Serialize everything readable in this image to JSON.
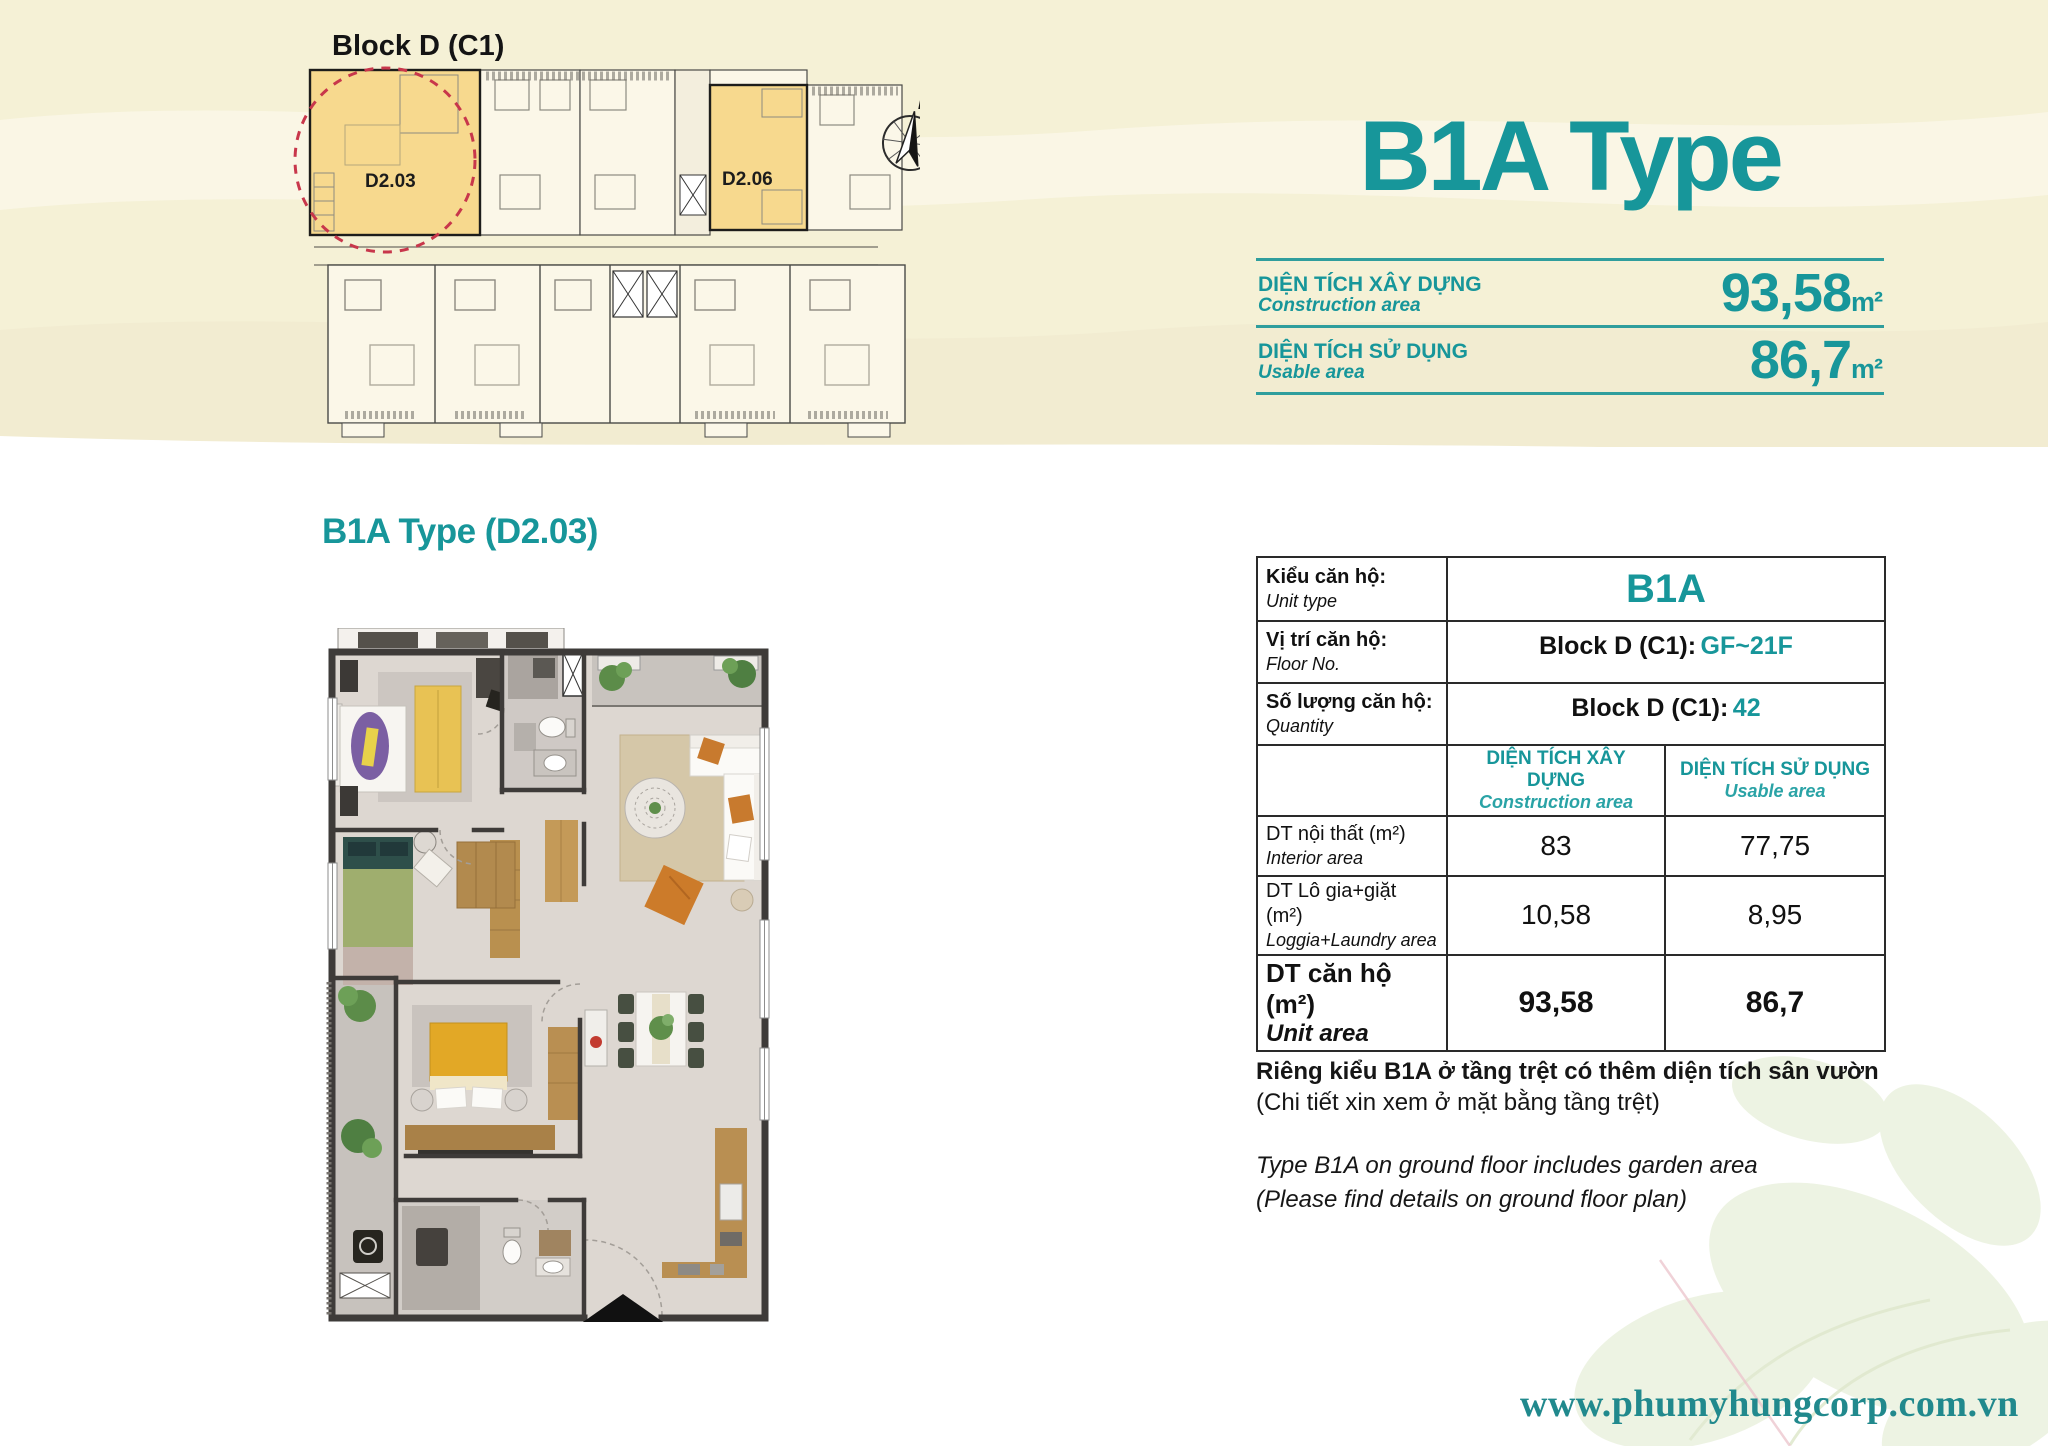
{
  "header": {
    "title": "B1A Type"
  },
  "block_plan": {
    "label": "Block D (C1)",
    "units": [
      {
        "id": "D2.03"
      },
      {
        "id": "D2.06"
      }
    ],
    "compass_label": "N"
  },
  "stats": {
    "rows": [
      {
        "label_vi": "DIỆN TÍCH XÂY DỰNG",
        "label_en": "Construction area",
        "value": "93,58",
        "unit": "m²"
      },
      {
        "label_vi": "DIỆN TÍCH SỬ DỤNG",
        "label_en": "Usable area",
        "value": "86,7",
        "unit": "m²"
      }
    ]
  },
  "plan": {
    "title": "B1A Type (D2.03)"
  },
  "table": {
    "rows": [
      {
        "label_vi": "Kiểu căn hộ:",
        "label_en": "Unit type",
        "value": "B1A"
      },
      {
        "label_vi": "Vị trí căn hộ:",
        "label_en": "Floor No.",
        "value_black": "Block D (C1):",
        "value_teal": "GF~21F"
      },
      {
        "label_vi": "Số lượng căn hộ:",
        "label_en": "Quantity",
        "value_black": "Block D (C1):",
        "value_teal": "42"
      }
    ],
    "col_headers": [
      {
        "vi": "DIỆN TÍCH XÂY DỰNG",
        "en": "Construction area"
      },
      {
        "vi": "DIỆN TÍCH SỬ DỤNG",
        "en": "Usable area"
      }
    ],
    "area_rows": [
      {
        "label_vi": "DT nội thất  (m²)",
        "label_en": "Interior area",
        "construction": "83",
        "usable": "77,75"
      },
      {
        "label_vi": "DT Lô gia+giặt  (m²)",
        "label_en": "Loggia+Laundry area",
        "construction": "10,58",
        "usable": "8,95"
      },
      {
        "label_vi": "DT căn hộ (m²)",
        "label_en": "Unit area",
        "construction": "93,58",
        "usable": "86,7"
      }
    ]
  },
  "notes": {
    "vi_bold": "Riêng kiểu B1A ở tầng trệt có thêm diện tích sân vườn",
    "vi_normal": "(Chi tiết xin xem ở mặt bằng tầng trệt)",
    "en_line1": "Type B1A on ground floor includes garden area",
    "en_line2": "(Please find details on ground floor plan)"
  },
  "footer": {
    "website": "www.phumyhungcorp.com.vn"
  },
  "colors": {
    "teal": "#17969a",
    "rule_teal": "#2f9e9d",
    "cream_band": "#f5f1d6",
    "unit_yellow": "#f7d98e",
    "circle_red": "#c8374b",
    "wall_dark": "#3e3b39",
    "link_teal": "#21898d"
  }
}
